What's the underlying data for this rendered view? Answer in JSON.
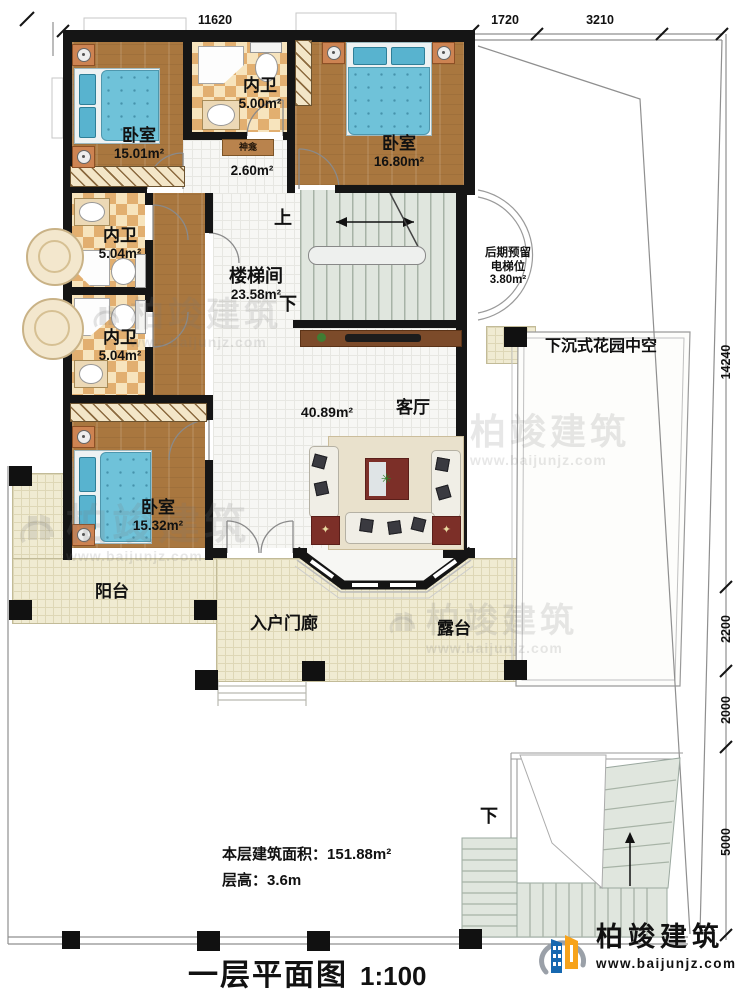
{
  "title": {
    "name": "一层平面图",
    "scale": "1:100"
  },
  "notes": {
    "area_label": "本层建筑面积：",
    "area_value": "151.88m²",
    "height_label": "层高：",
    "height_value": "3.6m"
  },
  "brand": {
    "name": "柏竣建筑",
    "url": "www.baijunjz.com"
  },
  "rooms": {
    "bedroom_tl": {
      "name": "卧室",
      "area": "15.01m²"
    },
    "bath_top": {
      "name": "内卫",
      "area": "5.00m²"
    },
    "shrine": {
      "name": "神龛",
      "area": "2.60m²"
    },
    "bedroom_tr": {
      "name": "卧室",
      "area": "16.80m²"
    },
    "bath_mid": {
      "name": "内卫",
      "area": "5.04m²"
    },
    "bath_low": {
      "name": "内卫",
      "area": "5.04m²"
    },
    "stair_hall": {
      "name": "楼梯间",
      "area": "23.58m²"
    },
    "elevator": {
      "name_line1": "后期预留",
      "name_line2": "电梯位",
      "area": "3.80m²"
    },
    "living": {
      "name": "客厅",
      "area": "40.89m²"
    },
    "bedroom_bl": {
      "name": "卧室",
      "area": "15.32m²"
    },
    "balcony": {
      "name": "阳台"
    },
    "porch": {
      "name": "入户门廊"
    },
    "terrace": {
      "name": "露台"
    },
    "garden": {
      "name": "下沉式花园中空"
    }
  },
  "stairs": {
    "up": "上",
    "down": "下",
    "outdoor_down": "下"
  },
  "dimensions": {
    "top": "11620",
    "top_right_1": "1720",
    "top_right_2": "3210",
    "right_total": "14240",
    "right_2": "2200",
    "right_3": "2000",
    "right_4": "5000"
  },
  "colors": {
    "wood": "#a9773f",
    "tile_tan": "#e2af70",
    "bed_blue": "#6fc2d9",
    "stair_green": "#e0e6de",
    "outdoor_cream": "#f0ebd2",
    "brand_blue": "#1668b0",
    "brand_orange": "#f7a31b"
  }
}
